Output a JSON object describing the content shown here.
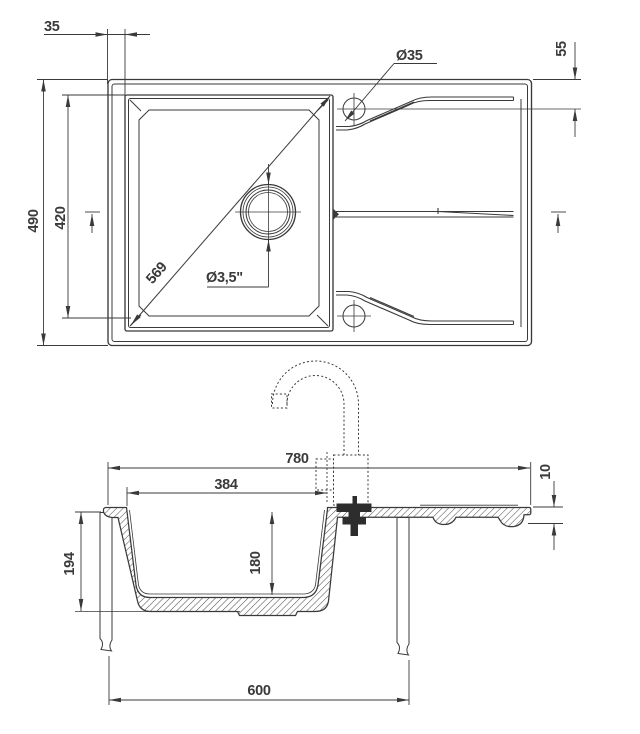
{
  "top_view": {
    "offset_label": "35",
    "hole_diameter_label": "Ø35",
    "edge_distance_label": "55",
    "height_label": "490",
    "bowl_height_label": "420",
    "diagonal_label": "569",
    "drain_label": "Ø3,5\""
  },
  "section_view": {
    "width_label": "780",
    "bowl_width_label": "384",
    "edge_thickness_label": "10",
    "depth_label": "194",
    "bowl_depth_label": "180",
    "cabinet_width_label": "600"
  },
  "colors": {
    "line": "#3a3a3a",
    "background": "#ffffff"
  }
}
